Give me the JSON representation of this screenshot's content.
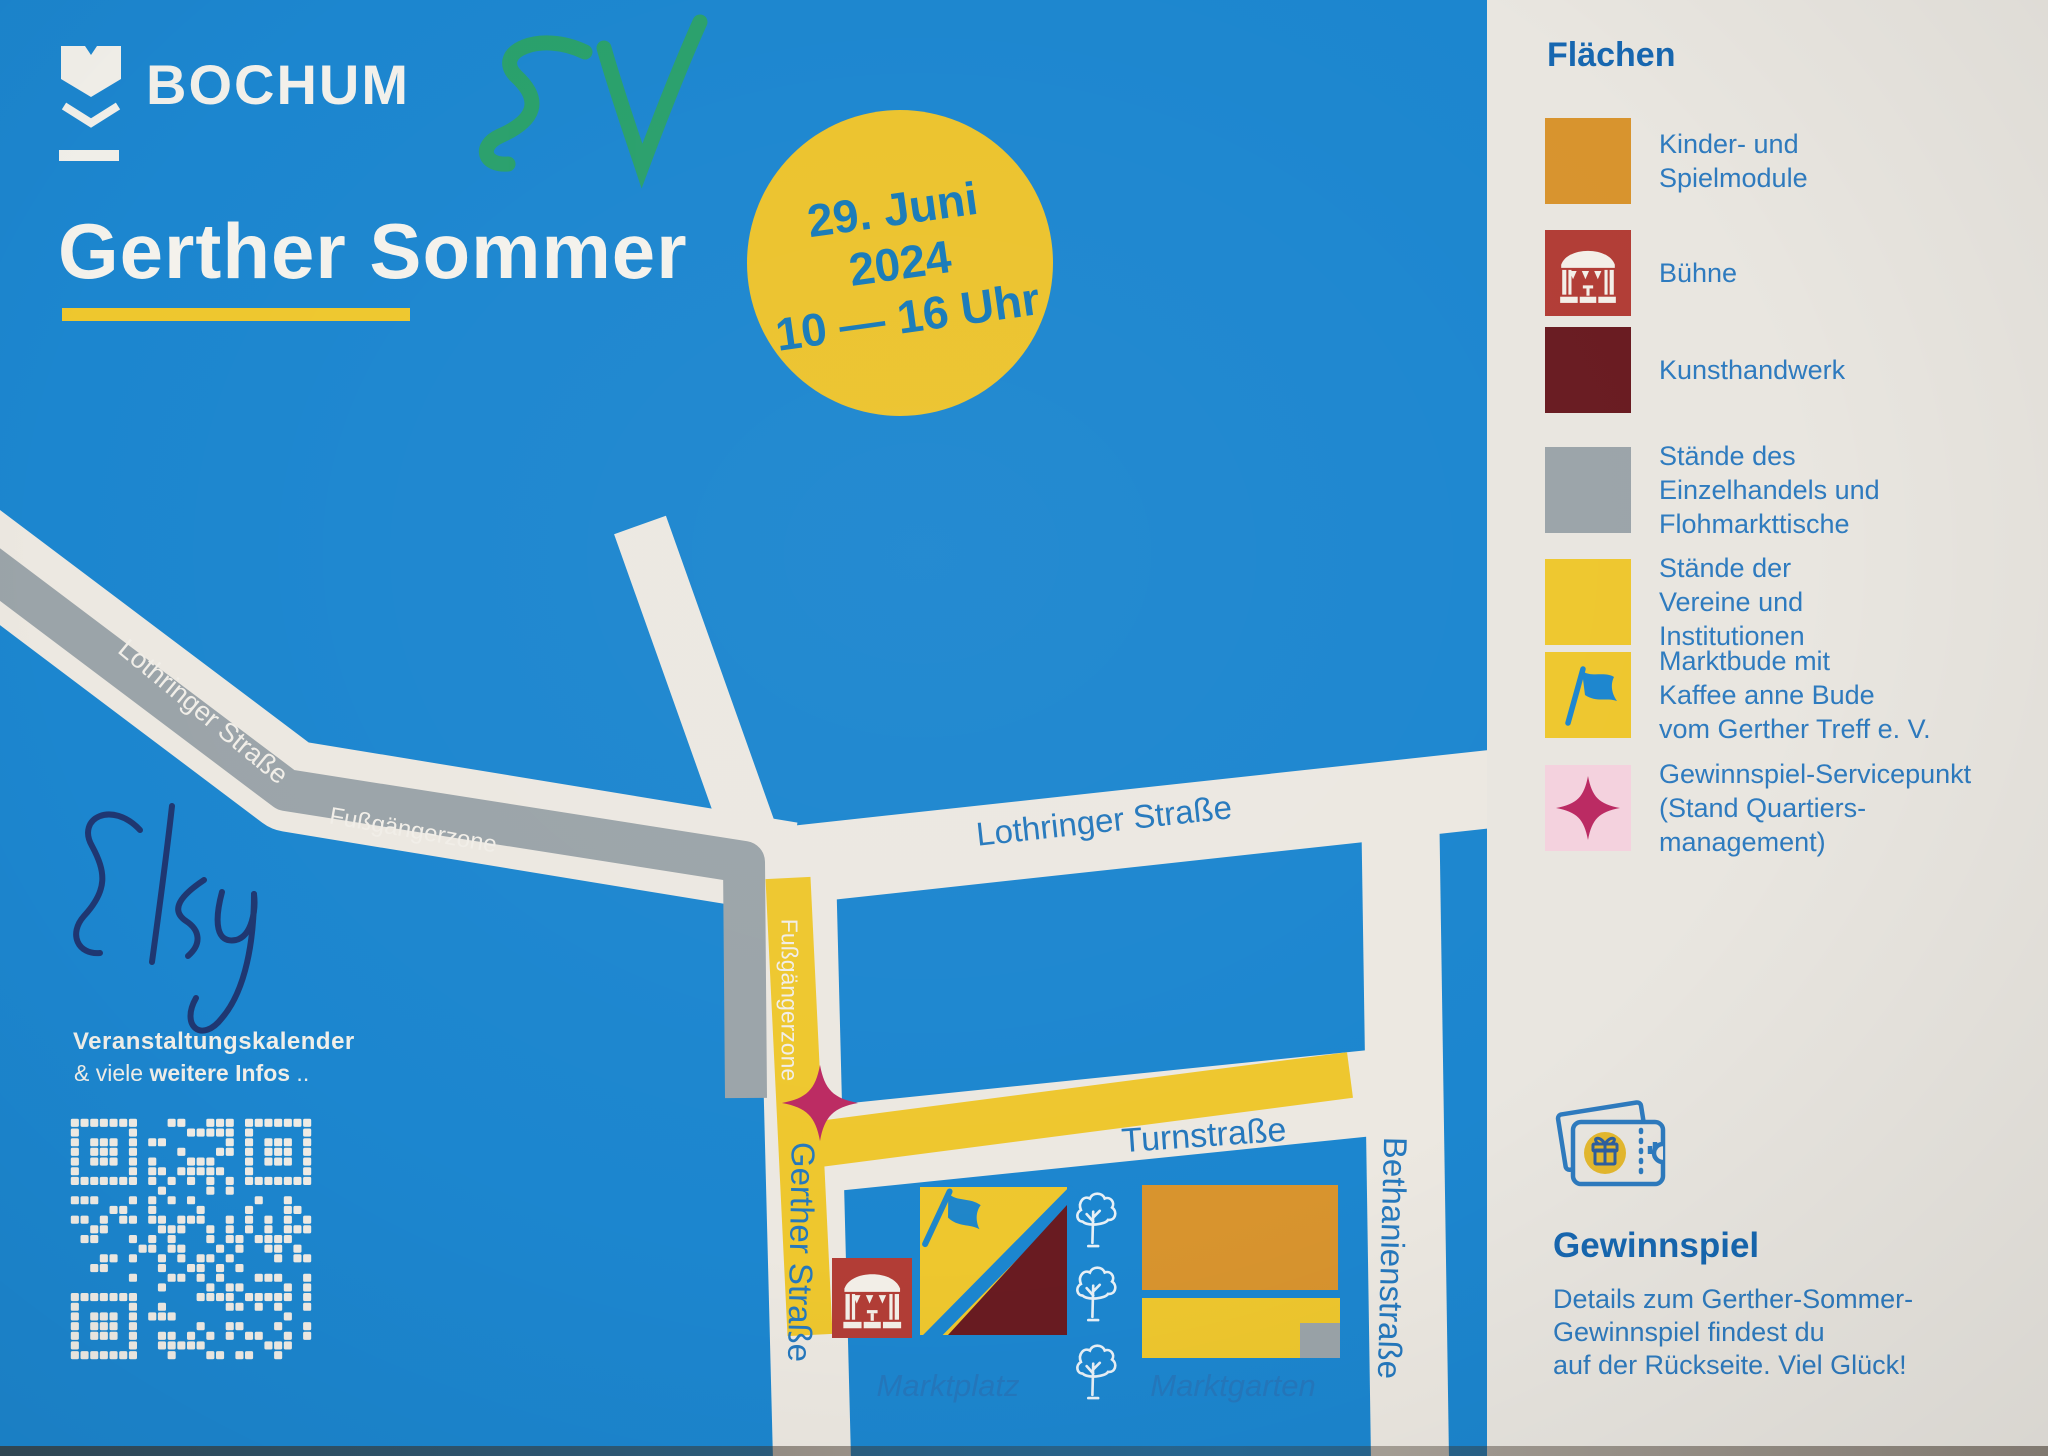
{
  "poster": {
    "brand": {
      "name": "BOCHUM"
    },
    "annotation_top": "SV",
    "title": "Gerther Sommer",
    "date_badge": {
      "date": "29. Juni",
      "year": "2024",
      "time": "10 — 16 Uhr"
    },
    "annotation_left": "Sky",
    "footer_note": {
      "line1": "Veranstaltungskalender",
      "line2_prefix": "& viele ",
      "line2_bold": "weitere Infos",
      "line2_suffix": " .."
    },
    "map": {
      "street_lothringer_west": "Lothringer Straße",
      "pedestrian_zone_west": "Fußgängerzone",
      "street_lothringer_east": "Lothringer Straße",
      "pedestrian_zone_south": "Fußgängerzone",
      "street_gerther": "Gerther Straße",
      "street_turn": "Turnstraße",
      "street_bethanien": "Bethanienstraße",
      "area_marktplatz": "Marktplatz",
      "area_marktgarten": "Marktgarten"
    }
  },
  "sidebar": {
    "legend_title": "Flächen",
    "legend": [
      {
        "label": "Kinder- und\nSpielmodule",
        "swatch": "#d8942e",
        "icon": null
      },
      {
        "label": "Bühne",
        "swatch": "#b23d36",
        "icon": "pavilion-icon"
      },
      {
        "label": "Kunsthandwerk",
        "swatch": "#691b21",
        "icon": null
      },
      {
        "label": "Stände des\nEinzelhandels und\nFlohmarkttische",
        "swatch": "#9ba4a9",
        "icon": null
      },
      {
        "label": "Stände der\nVereine und\nInstitutionen",
        "swatch": "#eec72e",
        "icon": null
      },
      {
        "label": "Marktbude mit\nKaffee anne Bude\nvom Gerther Treff e. V.",
        "swatch": "#eec72e",
        "icon": "flag-icon"
      },
      {
        "label": "Gewinnspiel-Servicepunkt\n(Stand Quartiers-\nmanagement)",
        "swatch": "#f4d2de",
        "icon": "sparkle-star-icon"
      }
    ],
    "gewinnspiel": {
      "title": "Gewinnspiel",
      "details": "Details zum Gerther-Sommer-\nGewinnspiel findest du\nauf der Rückseite. Viel Glück!"
    }
  },
  "colors": {
    "background_blue": "#1c86cf",
    "road_white": "#ece8e1",
    "pedestrian_gray": "#9ba4a9",
    "accent_yellow": "#eec72e",
    "module_orange": "#d8942e",
    "stage_red": "#b23d36",
    "craft_maroon": "#691b21",
    "star_magenta": "#bb2a62",
    "star_pink_bg": "#f4d2de",
    "heading_blue": "#1767b0",
    "text_blue": "#2e7bbf",
    "map_label_blue": "#2578bd",
    "date_text_blue": "#177ab8",
    "handwriting_green": "#2ba264",
    "handwriting_navy": "#20316a"
  }
}
